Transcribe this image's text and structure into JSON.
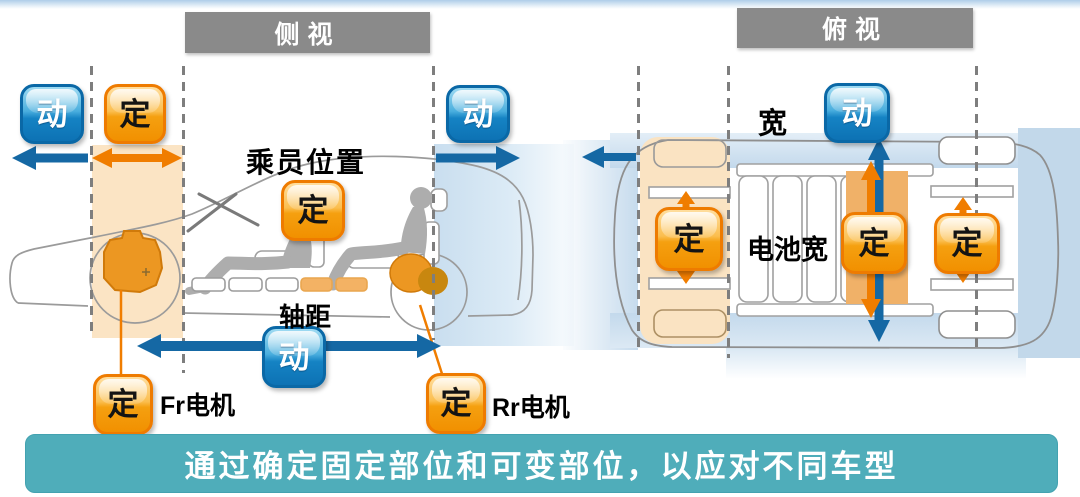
{
  "side_view": {
    "header": "侧视",
    "passenger_position_label": "乘员位置",
    "wheelbase_label": "轴距",
    "front_motor_label": "Fr电机",
    "rear_motor_label": "Rr电机"
  },
  "top_view": {
    "header": "俯视",
    "width_label": "宽",
    "battery_width_label": "电池宽"
  },
  "badges": {
    "fixed": "定",
    "variable": "动"
  },
  "banner_text": "通过确定固定部位和可变部位，以应对不同车型",
  "colors": {
    "fixed_badge_orange": "#F29200",
    "variable_badge_blue": "#0D72B4",
    "arrow_blue": "#1568A4",
    "arrow_orange": "#F07D00",
    "band_light_orange": "#FBE4C4",
    "band_mid_orange": "#F0B168",
    "band_light_blue": "#C8DDEE",
    "header_gray": "#8A8A8A",
    "banner_teal": "#4FADBA"
  }
}
